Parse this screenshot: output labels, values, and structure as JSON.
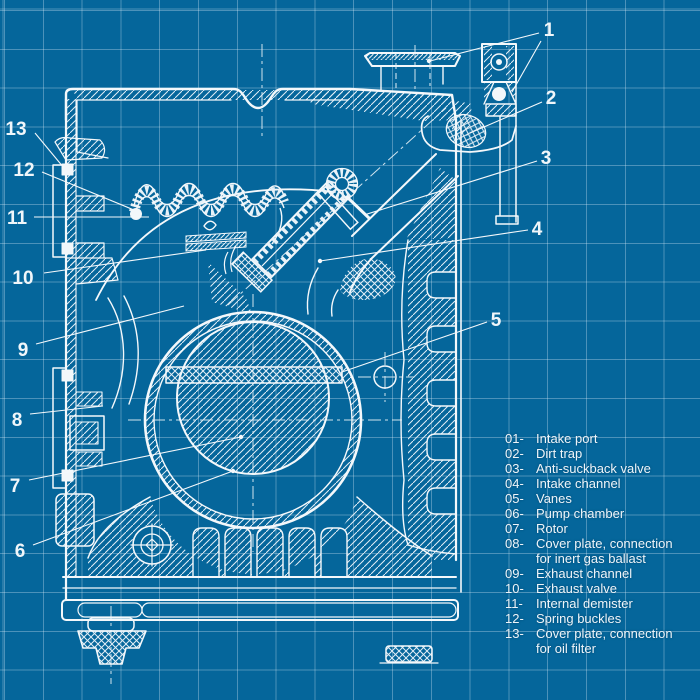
{
  "colors": {
    "background": "#05669b",
    "grid": "rgba(222,238,248,0.33)",
    "line": "#f4f8fb",
    "hatch": "#e2eef6",
    "text": "#eef5fa"
  },
  "callouts": [
    "1",
    "2",
    "3",
    "4",
    "5",
    "6",
    "7",
    "8",
    "9",
    "10",
    "11",
    "12",
    "13"
  ],
  "legend": [
    {
      "num": "01-",
      "label": "Intake port"
    },
    {
      "num": "02-",
      "label": "Dirt trap"
    },
    {
      "num": "03-",
      "label": "Anti-suckback valve"
    },
    {
      "num": "04-",
      "label": "Intake channel"
    },
    {
      "num": "05-",
      "label": "Vanes"
    },
    {
      "num": "06-",
      "label": "Pump chamber"
    },
    {
      "num": "07-",
      "label": "Rotor"
    },
    {
      "num": "08-",
      "label": "Cover plate, connection",
      "label2": "for inert gas ballast"
    },
    {
      "num": "09-",
      "label": "Exhaust channel"
    },
    {
      "num": "10-",
      "label": "Exhaust valve"
    },
    {
      "num": "11-",
      "label": "Internal demister"
    },
    {
      "num": "12-",
      "label": "Spring buckles"
    },
    {
      "num": "13-",
      "label": "Cover plate, connection",
      "label2": "for oil filter"
    }
  ]
}
